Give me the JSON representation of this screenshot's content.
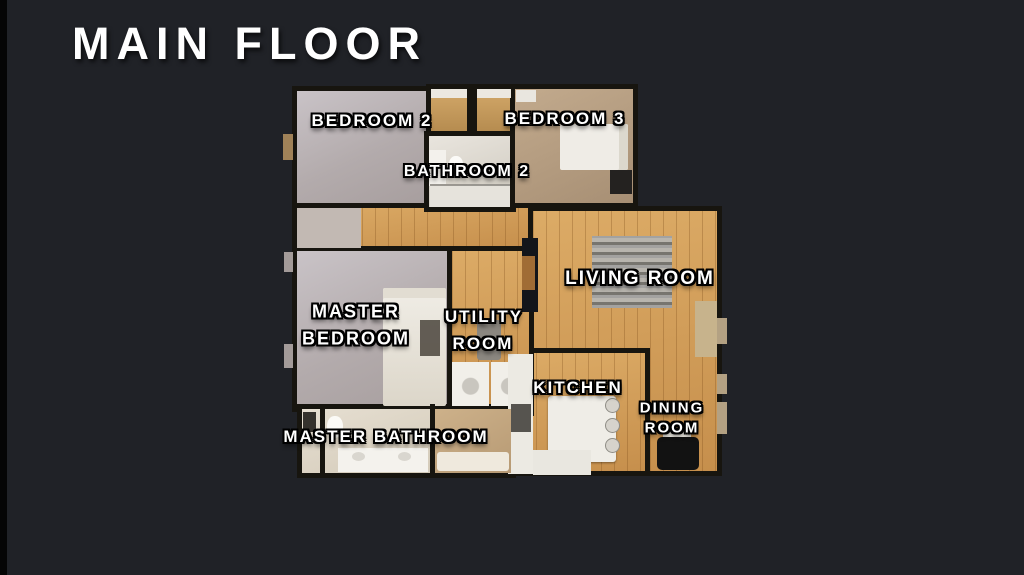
{
  "title": "MAIN FLOOR",
  "rooms": {
    "bedroom2": {
      "label": "BEDROOM 2"
    },
    "bedroom3": {
      "label": "BEDROOM 3"
    },
    "bathroom2": {
      "label": "BATHROOM 2"
    },
    "master_bedroom": {
      "line1": "MASTER",
      "line2": "BEDROOM"
    },
    "utility_room": {
      "line1": "UTILITY",
      "line2": "ROOM"
    },
    "living_room": {
      "label": "LIVING ROOM"
    },
    "kitchen": {
      "label": "KITCHEN"
    },
    "dining_room": {
      "line1": "DINING",
      "line2": "ROOM"
    },
    "master_bathroom": {
      "label": "MASTER BATHROOM"
    }
  },
  "colors": {
    "background": "#202227",
    "left_edge_strip": "#050505",
    "wall": "#17150f",
    "wood_floor": "#cf9a56",
    "carpet_gray": "#b9b2b4",
    "carpet_tan": "#b49a7d",
    "bathroom_tile": "#ddd8cf",
    "title_text": "#ffffff",
    "label_text": "#ffffff"
  }
}
